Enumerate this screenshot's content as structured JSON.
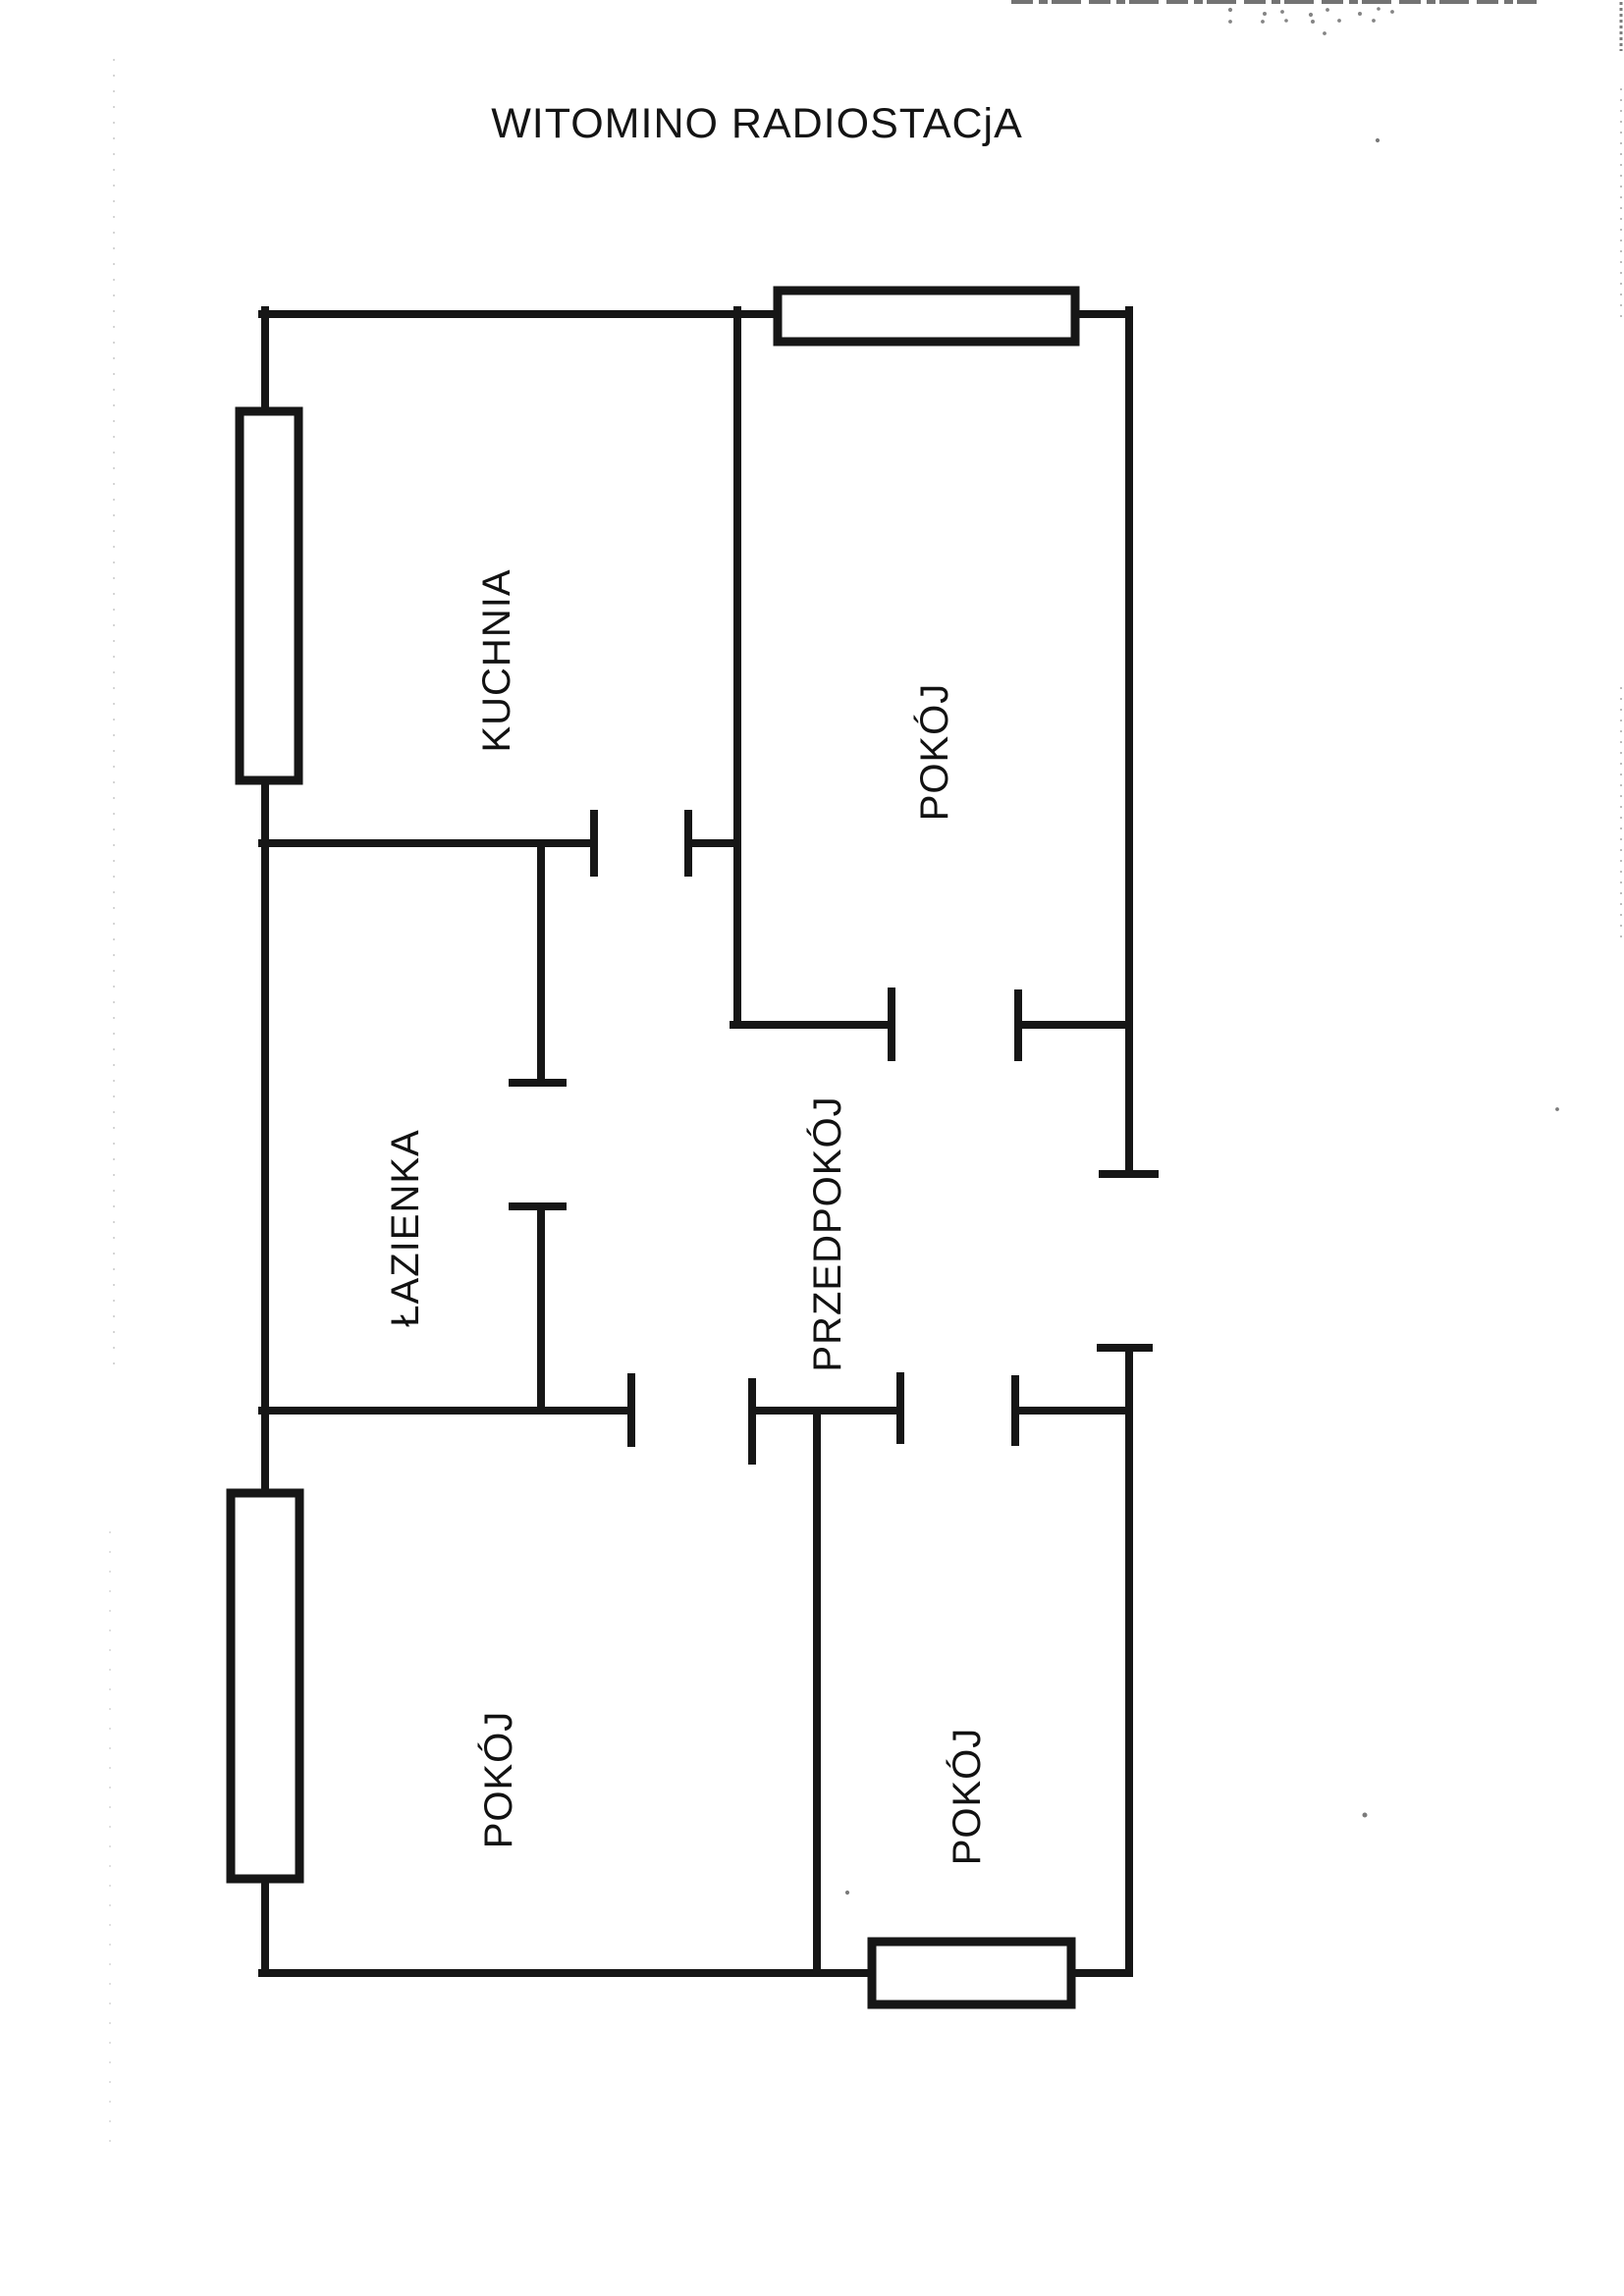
{
  "page": {
    "title": "WITOMINO RADIOSTACjA"
  },
  "rooms": {
    "kuchnia": {
      "label": "KUCHNIA"
    },
    "pokoj_top_right": {
      "label": "POKÓJ"
    },
    "lazienka": {
      "label": "ŁAZIENKA"
    },
    "przedpokoj": {
      "label": "PRZEDPOKÓJ"
    },
    "pokoj_bottom_left": {
      "label": "POKÓJ"
    },
    "pokoj_bottom_right": {
      "label": "POKÓJ"
    }
  },
  "colors": {
    "ink": "#161616",
    "paper": "#ffffff"
  }
}
